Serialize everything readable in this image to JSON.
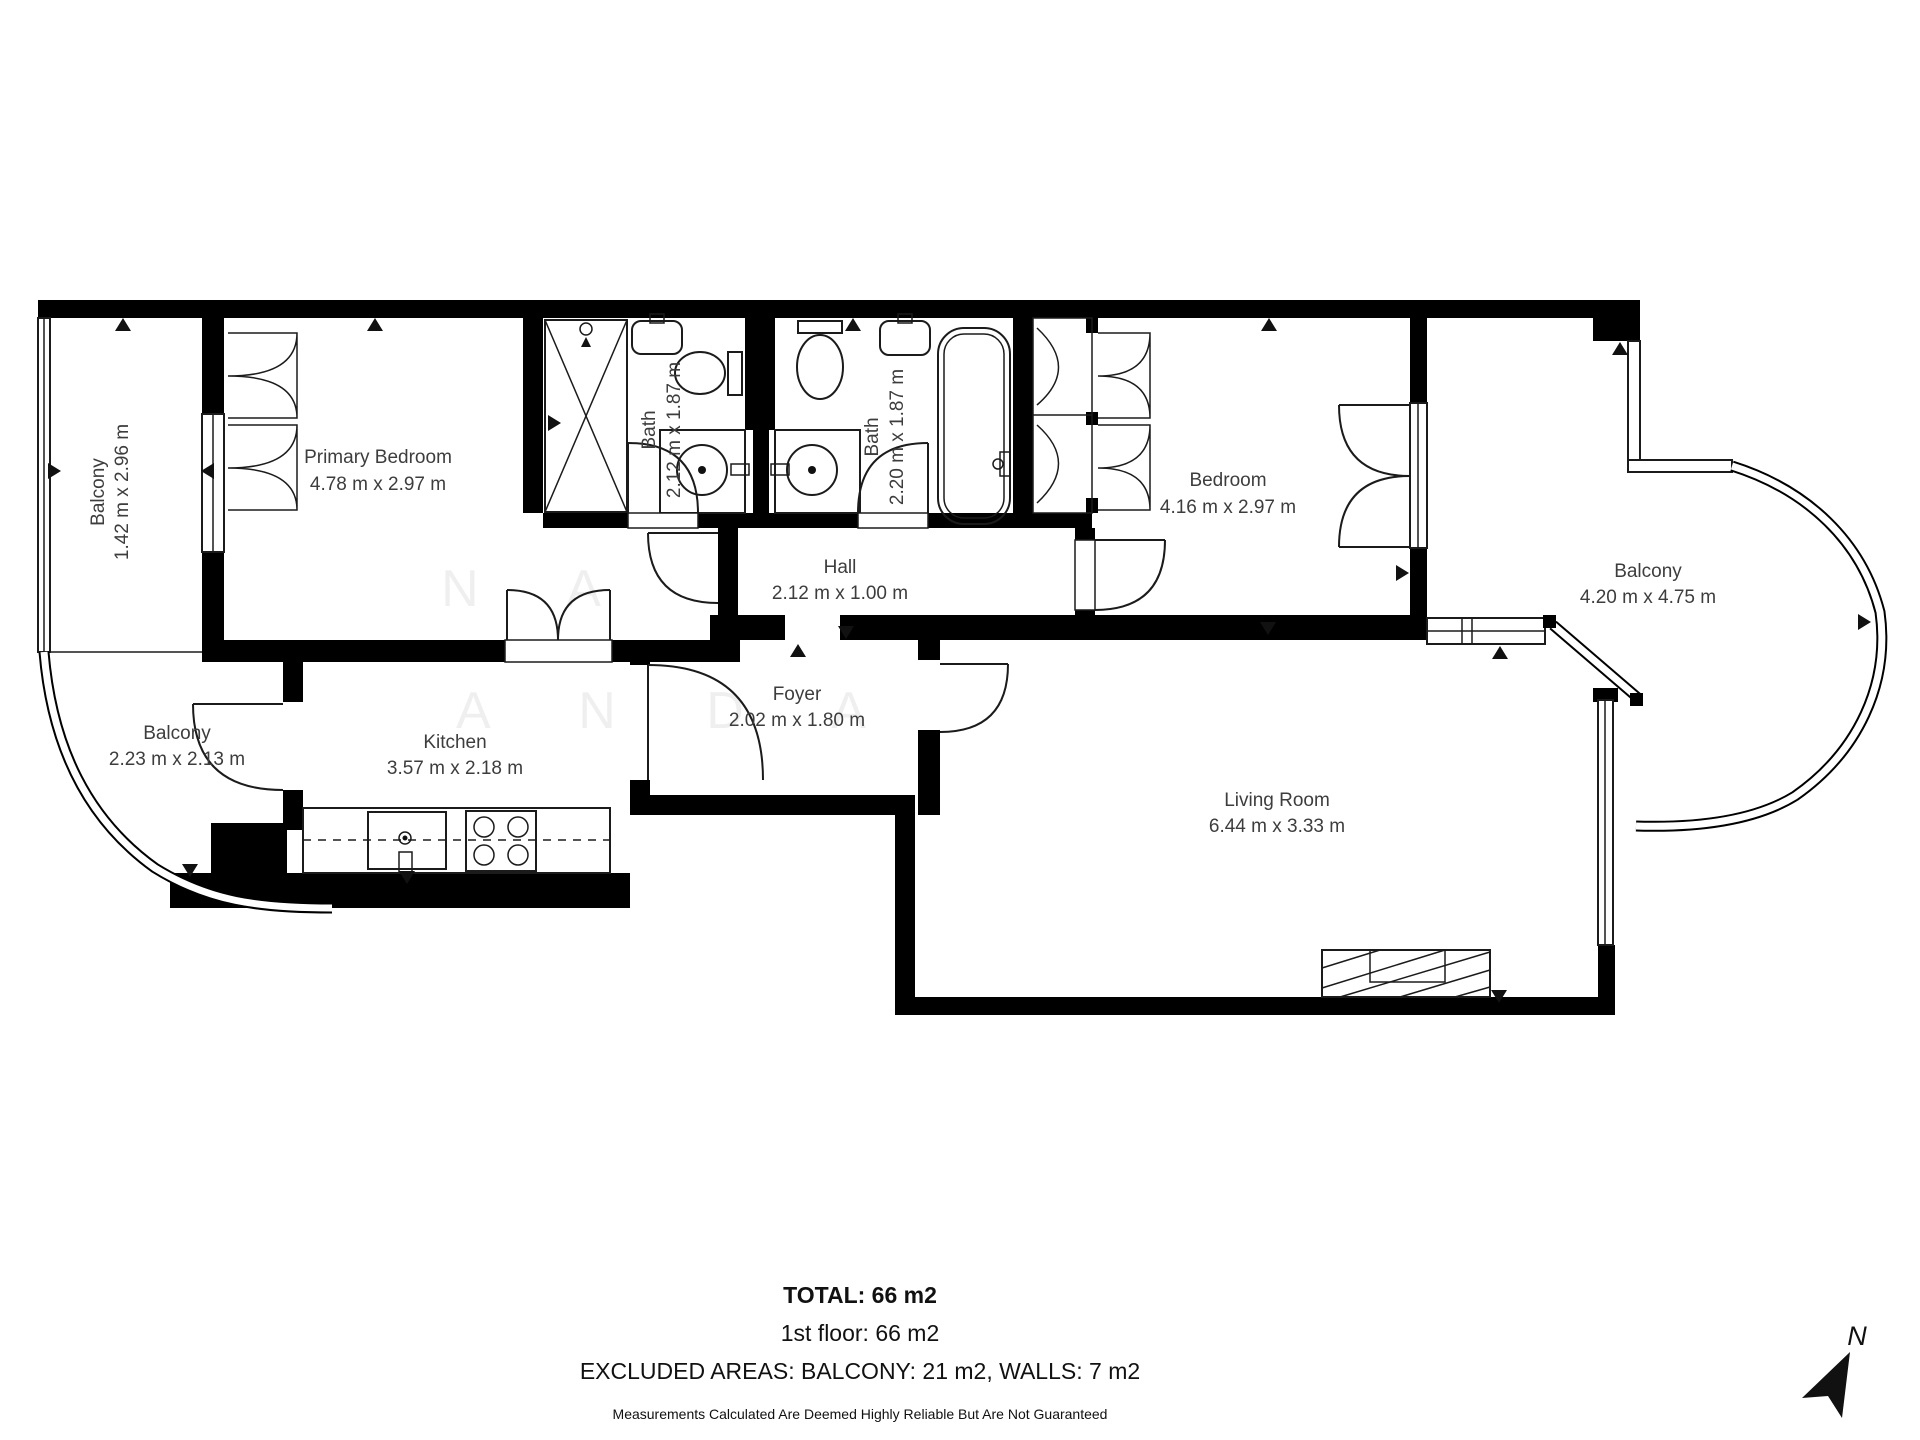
{
  "rooms": {
    "primary_bedroom": {
      "name": "Primary Bedroom",
      "dims": "4.78 m x 2.97 m"
    },
    "balcony_left": {
      "name": "Balcony",
      "dims": "1.42 m x 2.96 m"
    },
    "bath_1": {
      "name": "Bath",
      "dims": "2.12 m x 1.87 m"
    },
    "bath_2": {
      "name": "Bath",
      "dims": "2.20 m x 1.87 m"
    },
    "bedroom": {
      "name": "Bedroom",
      "dims": "4.16 m x 2.97 m"
    },
    "hall": {
      "name": "Hall",
      "dims": "2.12 m x 1.00 m"
    },
    "foyer": {
      "name": "Foyer",
      "dims": "2.02 m x 1.80 m"
    },
    "kitchen": {
      "name": "Kitchen",
      "dims": "3.57 m x 2.18 m"
    },
    "balcony_lower": {
      "name": "Balcony",
      "dims": "2.23 m x 2.13 m"
    },
    "living_room": {
      "name": "Living Room",
      "dims": "6.44 m x 3.33 m"
    },
    "balcony_right": {
      "name": "Balcony",
      "dims": "4.20 m x 4.75 m"
    }
  },
  "compass": {
    "label": "N"
  },
  "watermark": {
    "row1": "N A",
    "row2": "A N D A"
  },
  "footer": {
    "total": "TOTAL: 66 m2",
    "floor": "1st floor: 66 m2",
    "excluded": "EXCLUDED AREAS: BALCONY: 21 m2, WALLS: 7 m2",
    "disclaimer": "Measurements Calculated Are Deemed Highly Reliable But Are Not Guaranteed"
  }
}
